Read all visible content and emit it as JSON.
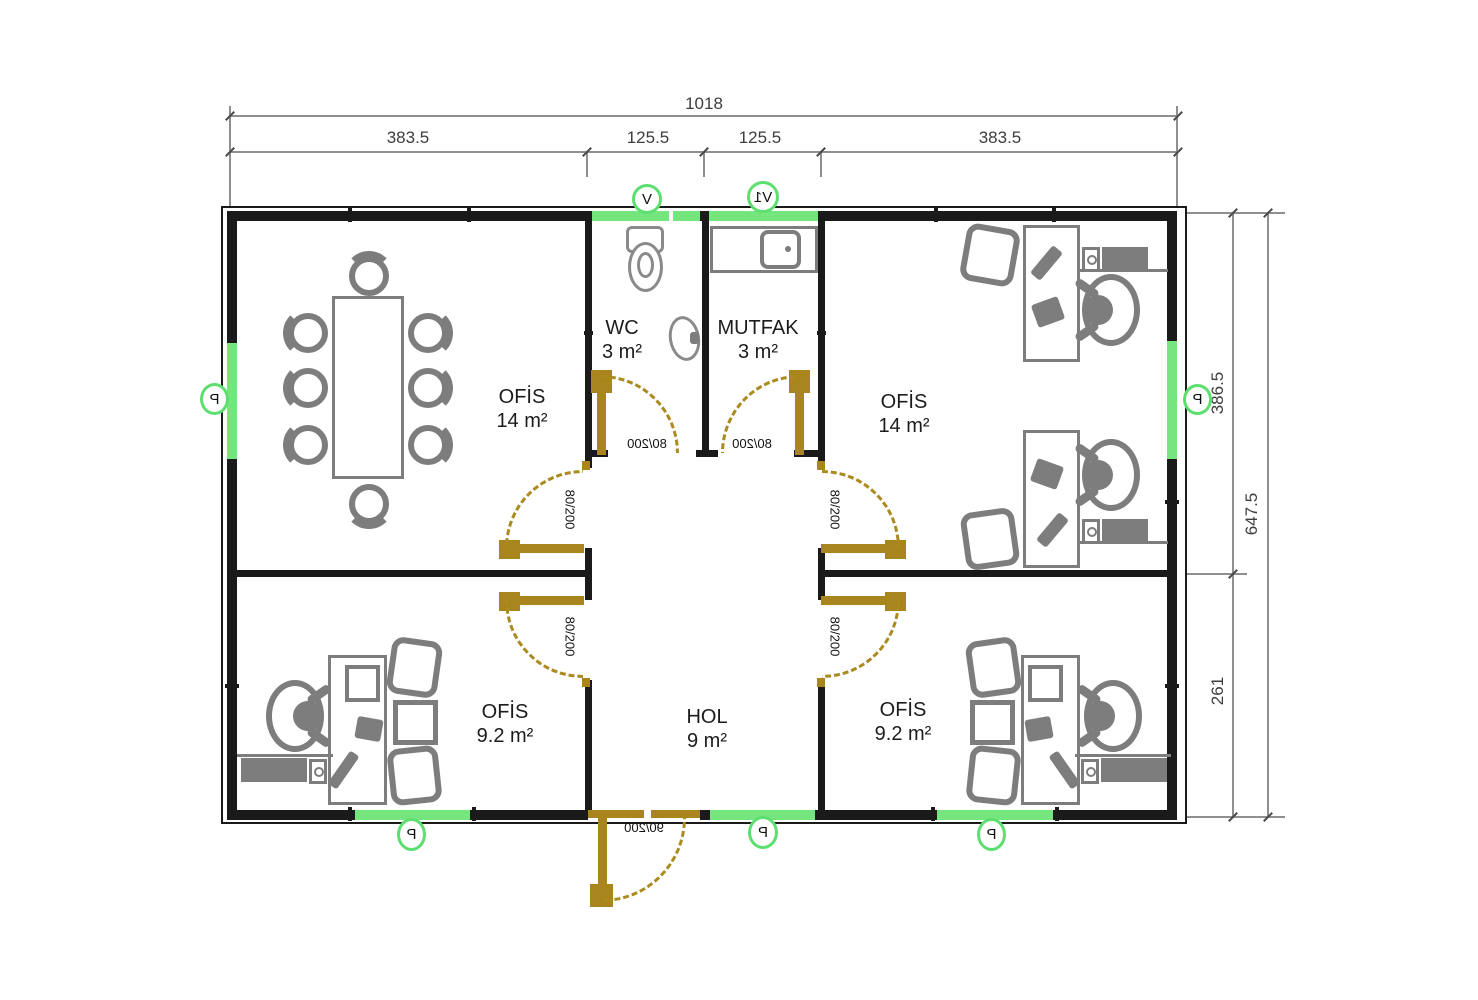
{
  "drawing": {
    "rooms": [
      {
        "name": "OFİS",
        "area": "14 m²"
      },
      {
        "name": "WC",
        "area": "3 m²"
      },
      {
        "name": "MUTFAK",
        "area": "3 m²"
      },
      {
        "name": "OFİS",
        "area": "14 m²"
      },
      {
        "name": "OFİS",
        "area": "9.2 m²"
      },
      {
        "name": "HOL",
        "area": "9 m²"
      },
      {
        "name": "OFİS",
        "area": "9.2 m²"
      }
    ],
    "doors": {
      "standard": "80/200",
      "entrance": "90/200"
    },
    "tags": {
      "p": "P",
      "v": "V",
      "v1": "V1"
    },
    "dims": {
      "top_total": "1018",
      "top_segments": [
        "383.5",
        "125.5",
        "125.5",
        "383.5"
      ],
      "right_total": "647.5",
      "right_segments": [
        "386.5",
        "261"
      ]
    },
    "colors": {
      "wall": "#1a1a1a",
      "window": "#75e67d",
      "door": "#a8861d",
      "furniture": "#7d7d7d"
    }
  }
}
